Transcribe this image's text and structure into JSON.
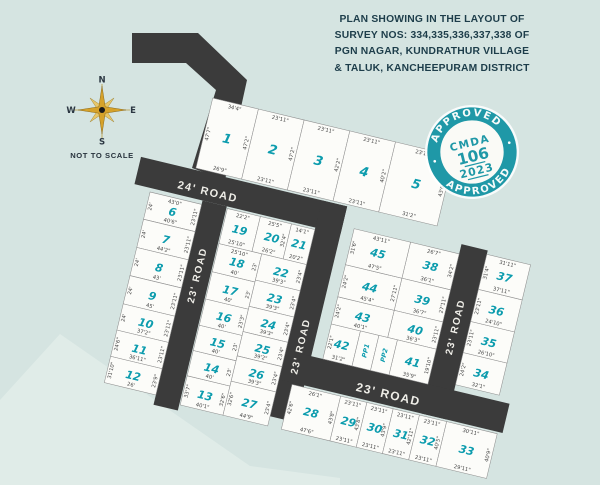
{
  "title": {
    "lines": [
      "PLAN SHOWING IN THE LAYOUT OF",
      "SURVEY NOS: 334,335,336,337,338 OF",
      "PGN NAGAR, KUNDRATHUR VILLAGE",
      "& TALUK, KANCHEEPURAM DISTRICT"
    ]
  },
  "compass": {
    "n": "N",
    "s": "S",
    "e": "E",
    "w": "W",
    "note": "NOT TO SCALE"
  },
  "stamp": {
    "top_text": "APPROVED",
    "bottom_text": "APPROVED",
    "org": "CMDA",
    "number": "106",
    "year": "2023"
  },
  "colors": {
    "bg": "#d5e4e1",
    "bg_light": "#e4efeb",
    "road": "#3b3b3b",
    "plot_fill": "#fcfcf9",
    "plot_stroke": "#8f8f8f",
    "plot_number": "#0d9cad",
    "teal": "#1f98a7",
    "title_text": "#1d3d4a",
    "dim_text": "#474747",
    "road_label": "#efeee8",
    "compass_gold": "#d6a22a"
  },
  "layout": {
    "rotation_deg": 13.5,
    "rotation_cx": 300,
    "rotation_cy": 300,
    "entry_road_path": "M132,33 L198,33 L247,80 L225,180 L192,168 L216,90 L186,63 L132,63 Z",
    "shore_path": "M0,400 L60,334 L250,466 L340,478 L340,485 L0,485 Z",
    "roads": [
      {
        "label": "24' ROAD",
        "x": 112,
        "y": 198,
        "w": 212,
        "h": 28,
        "lx": 185,
        "ly": 216,
        "rot": 0,
        "fs": 11
      },
      {
        "label": "23' ROAD",
        "x": 182,
        "y": 226,
        "w": 25,
        "h": 210,
        "lx": 194,
        "ly": 300,
        "rot": -90,
        "fs": 10
      },
      {
        "label": "23' ROAD",
        "x": 298,
        "y": 198,
        "w": 26,
        "h": 222,
        "lx": 311,
        "ly": 345,
        "rot": -90,
        "fs": 10
      },
      {
        "label": "23' ROAD",
        "x": 444,
        "y": 208,
        "w": 27,
        "h": 174,
        "lx": 457,
        "ly": 290,
        "rot": -90,
        "fs": 10
      },
      {
        "label": "23' ROAD",
        "x": 298,
        "y": 352,
        "w": 230,
        "h": 30,
        "lx": 408,
        "ly": 371,
        "rot": 0,
        "fs": 12
      }
    ],
    "plots": [
      {
        "n": "1",
        "x": 168,
        "y": 124,
        "w": 47,
        "h": 72,
        "fs": 13,
        "d": {
          "t": "34'4\"",
          "r": "47'2\"",
          "b": "26'9\"",
          "l": "47'7\""
        }
      },
      {
        "n": "2",
        "x": 215,
        "y": 124,
        "w": 47,
        "h": 72,
        "fs": 13,
        "d": {
          "t": "23'11\"",
          "r": "47'2\"",
          "b": "23'11\""
        }
      },
      {
        "n": "3",
        "x": 262,
        "y": 124,
        "w": 47,
        "h": 72,
        "fs": 13,
        "d": {
          "t": "23'11\"",
          "r": "42'2\"",
          "b": "23'11\""
        }
      },
      {
        "n": "4",
        "x": 309,
        "y": 124,
        "w": 47,
        "h": 72,
        "fs": 13,
        "d": {
          "t": "23'11\"",
          "r": "40'2\"",
          "b": "23'11\""
        }
      },
      {
        "n": "5",
        "x": 356,
        "y": 124,
        "w": 60,
        "h": 72,
        "fs": 13,
        "d": {
          "t": "23'11\"",
          "r": "43'6\"",
          "b": "31'2\""
        }
      },
      {
        "n": "6",
        "x": 129,
        "y": 230,
        "w": 53,
        "h": 28,
        "d": {
          "t": "43'0\"",
          "b": "40'6\"",
          "l": "24'",
          "r": "23'11\""
        }
      },
      {
        "n": "7",
        "x": 129,
        "y": 258,
        "w": 53,
        "h": 29,
        "d": {
          "b": "44'2\"",
          "l": "24'",
          "r": "23'11\""
        }
      },
      {
        "n": "8",
        "x": 129,
        "y": 287,
        "w": 53,
        "h": 29,
        "d": {
          "b": "43'",
          "l": "24'",
          "r": "23'11\""
        }
      },
      {
        "n": "9",
        "x": 129,
        "y": 316,
        "w": 53,
        "h": 29,
        "d": {
          "b": "45'",
          "l": "24'",
          "r": "23'11\""
        }
      },
      {
        "n": "10",
        "x": 129,
        "y": 345,
        "w": 53,
        "h": 27,
        "d": {
          "b": "37'2\"",
          "l": "24'",
          "r": "23'11\""
        }
      },
      {
        "n": "11",
        "x": 129,
        "y": 372,
        "w": 53,
        "h": 27,
        "d": {
          "b": "36'11\"",
          "l": "24'6\"",
          "r": "23'11\""
        }
      },
      {
        "n": "12",
        "x": 129,
        "y": 399,
        "w": 53,
        "h": 27,
        "d": {
          "b": "26'",
          "l": "31'10\"",
          "r": "23'9\""
        }
      },
      {
        "n": "13",
        "x": 208,
        "y": 400,
        "w": 44,
        "h": 30,
        "d": {
          "b": "40'1\"",
          "l": "33'7\"",
          "r": "32'6\""
        }
      },
      {
        "n": "14",
        "x": 208,
        "y": 374,
        "w": 44,
        "h": 26,
        "d": {
          "b": "40'",
          "r": "23'"
        }
      },
      {
        "n": "15",
        "x": 208,
        "y": 348,
        "w": 44,
        "h": 26,
        "d": {
          "b": "40'",
          "r": "23'"
        }
      },
      {
        "n": "16",
        "x": 208,
        "y": 321,
        "w": 44,
        "h": 27,
        "d": {
          "b": "40'",
          "r": "23'3\""
        }
      },
      {
        "n": "17",
        "x": 208,
        "y": 293,
        "w": 44,
        "h": 28,
        "d": {
          "b": "40'",
          "r": "23'"
        }
      },
      {
        "n": "18",
        "x": 208,
        "y": 264,
        "w": 44,
        "h": 29,
        "d": {
          "t": "25'10\"",
          "b": "40'",
          "r": "23'"
        }
      },
      {
        "n": "19",
        "x": 208,
        "y": 228,
        "w": 34,
        "h": 36,
        "d": {
          "t": "22'2\"",
          "b": "25'10\""
        }
      },
      {
        "n": "20",
        "x": 242,
        "y": 228,
        "w": 32,
        "h": 36,
        "d": {
          "t": "25'5\"",
          "b": "26'2\"",
          "r": "32'4\""
        }
      },
      {
        "n": "21",
        "x": 274,
        "y": 228,
        "w": 24,
        "h": 36,
        "d": {
          "t": "14'1\"",
          "b": "20'2\""
        }
      },
      {
        "n": "22",
        "x": 252,
        "y": 264,
        "w": 46,
        "h": 27,
        "d": {
          "b": "39'3\"",
          "r": "23'4\""
        }
      },
      {
        "n": "23",
        "x": 252,
        "y": 291,
        "w": 46,
        "h": 27,
        "d": {
          "b": "39'3\"",
          "r": "23'4\""
        }
      },
      {
        "n": "24",
        "x": 252,
        "y": 318,
        "w": 46,
        "h": 26,
        "d": {
          "b": "39'3\"",
          "r": "23'4\""
        }
      },
      {
        "n": "25",
        "x": 252,
        "y": 344,
        "w": 46,
        "h": 25,
        "d": {
          "b": "39'2\"",
          "r": "23'4\""
        }
      },
      {
        "n": "26",
        "x": 252,
        "y": 369,
        "w": 46,
        "h": 26,
        "d": {
          "b": "39'3\"",
          "r": "23'4\""
        }
      },
      {
        "n": "27",
        "x": 252,
        "y": 395,
        "w": 46,
        "h": 35,
        "d": {
          "b": "44'9\"",
          "l": "32'6\"",
          "r": "23'4\""
        }
      },
      {
        "n": "28",
        "x": 312,
        "y": 384,
        "w": 50,
        "h": 46,
        "d": {
          "t": "26'1\"",
          "l": "42'6\"",
          "b": "47'6\"",
          "r": "43'8\""
        }
      },
      {
        "n": "29",
        "x": 362,
        "y": 384,
        "w": 27,
        "h": 46,
        "d": {
          "t": "23'11\"",
          "b": "23'11\"",
          "r": "43'8\""
        }
      },
      {
        "n": "30",
        "x": 389,
        "y": 384,
        "w": 27,
        "h": 46,
        "d": {
          "t": "23'11\"",
          "b": "23'11\"",
          "r": "43'9\""
        }
      },
      {
        "n": "31",
        "x": 416,
        "y": 384,
        "w": 27,
        "h": 46,
        "d": {
          "t": "23'11\"",
          "b": "23'11\"",
          "r": "42'11\""
        }
      },
      {
        "n": "32",
        "x": 443,
        "y": 384,
        "w": 28,
        "h": 46,
        "d": {
          "t": "23'11\"",
          "b": "23'11\"",
          "r": "40'5\""
        }
      },
      {
        "n": "33",
        "x": 471,
        "y": 384,
        "w": 52,
        "h": 46,
        "d": {
          "t": "30'11\"",
          "b": "29'11\"",
          "r": "40'9\""
        }
      },
      {
        "n": "34",
        "x": 471,
        "y": 313,
        "w": 45,
        "h": 33,
        "d": {
          "b": "32'1\"",
          "l": "24'2\""
        }
      },
      {
        "n": "35",
        "x": 471,
        "y": 281,
        "w": 45,
        "h": 32,
        "d": {
          "b": "26'10\"",
          "l": "23'11\""
        }
      },
      {
        "n": "36",
        "x": 471,
        "y": 248,
        "w": 45,
        "h": 33,
        "d": {
          "b": "24'10\"",
          "l": "23'11\""
        }
      },
      {
        "n": "37",
        "x": 471,
        "y": 212,
        "w": 45,
        "h": 36,
        "d": {
          "t": "31'11\"",
          "b": "37'11\"",
          "l": "31'4\""
        }
      },
      {
        "n": "38",
        "x": 394,
        "y": 218,
        "w": 50,
        "h": 37,
        "d": {
          "t": "26'7\"",
          "b": "36'1\"",
          "r": "34'2\""
        }
      },
      {
        "n": "39",
        "x": 394,
        "y": 255,
        "w": 50,
        "h": 33,
        "d": {
          "b": "36'7\"",
          "r": "27'11\""
        }
      },
      {
        "n": "40",
        "x": 394,
        "y": 288,
        "w": 50,
        "h": 28,
        "d": {
          "b": "36'3\"",
          "r": "23'11\""
        }
      },
      {
        "n": "41",
        "x": 404,
        "y": 316,
        "w": 40,
        "h": 36,
        "d": {
          "b": "35'9\"",
          "r": "19'10\""
        }
      },
      {
        "n": "42",
        "x": 336,
        "y": 316,
        "w": 30,
        "h": 36,
        "d": {
          "b": "31'2\"",
          "l": "22'1\""
        }
      },
      {
        "n": "43",
        "x": 336,
        "y": 288,
        "w": 58,
        "h": 28,
        "d": {
          "b": "40'1\"",
          "l": "24'2\""
        }
      },
      {
        "n": "44",
        "x": 336,
        "y": 255,
        "w": 58,
        "h": 33,
        "d": {
          "b": "45'4\"",
          "l": "24'2\"",
          "r": "27'11\""
        }
      },
      {
        "n": "45",
        "x": 336,
        "y": 218,
        "w": 58,
        "h": 37,
        "d": {
          "t": "43'11\"",
          "b": "47'5\"",
          "l": "31'6\""
        }
      },
      {
        "n": "PP1",
        "x": 366,
        "y": 316,
        "w": 19,
        "h": 36,
        "fs": 6.5,
        "rot": -90
      },
      {
        "n": "PP2",
        "x": 385,
        "y": 316,
        "w": 19,
        "h": 36,
        "fs": 6.5,
        "rot": -90
      }
    ]
  }
}
